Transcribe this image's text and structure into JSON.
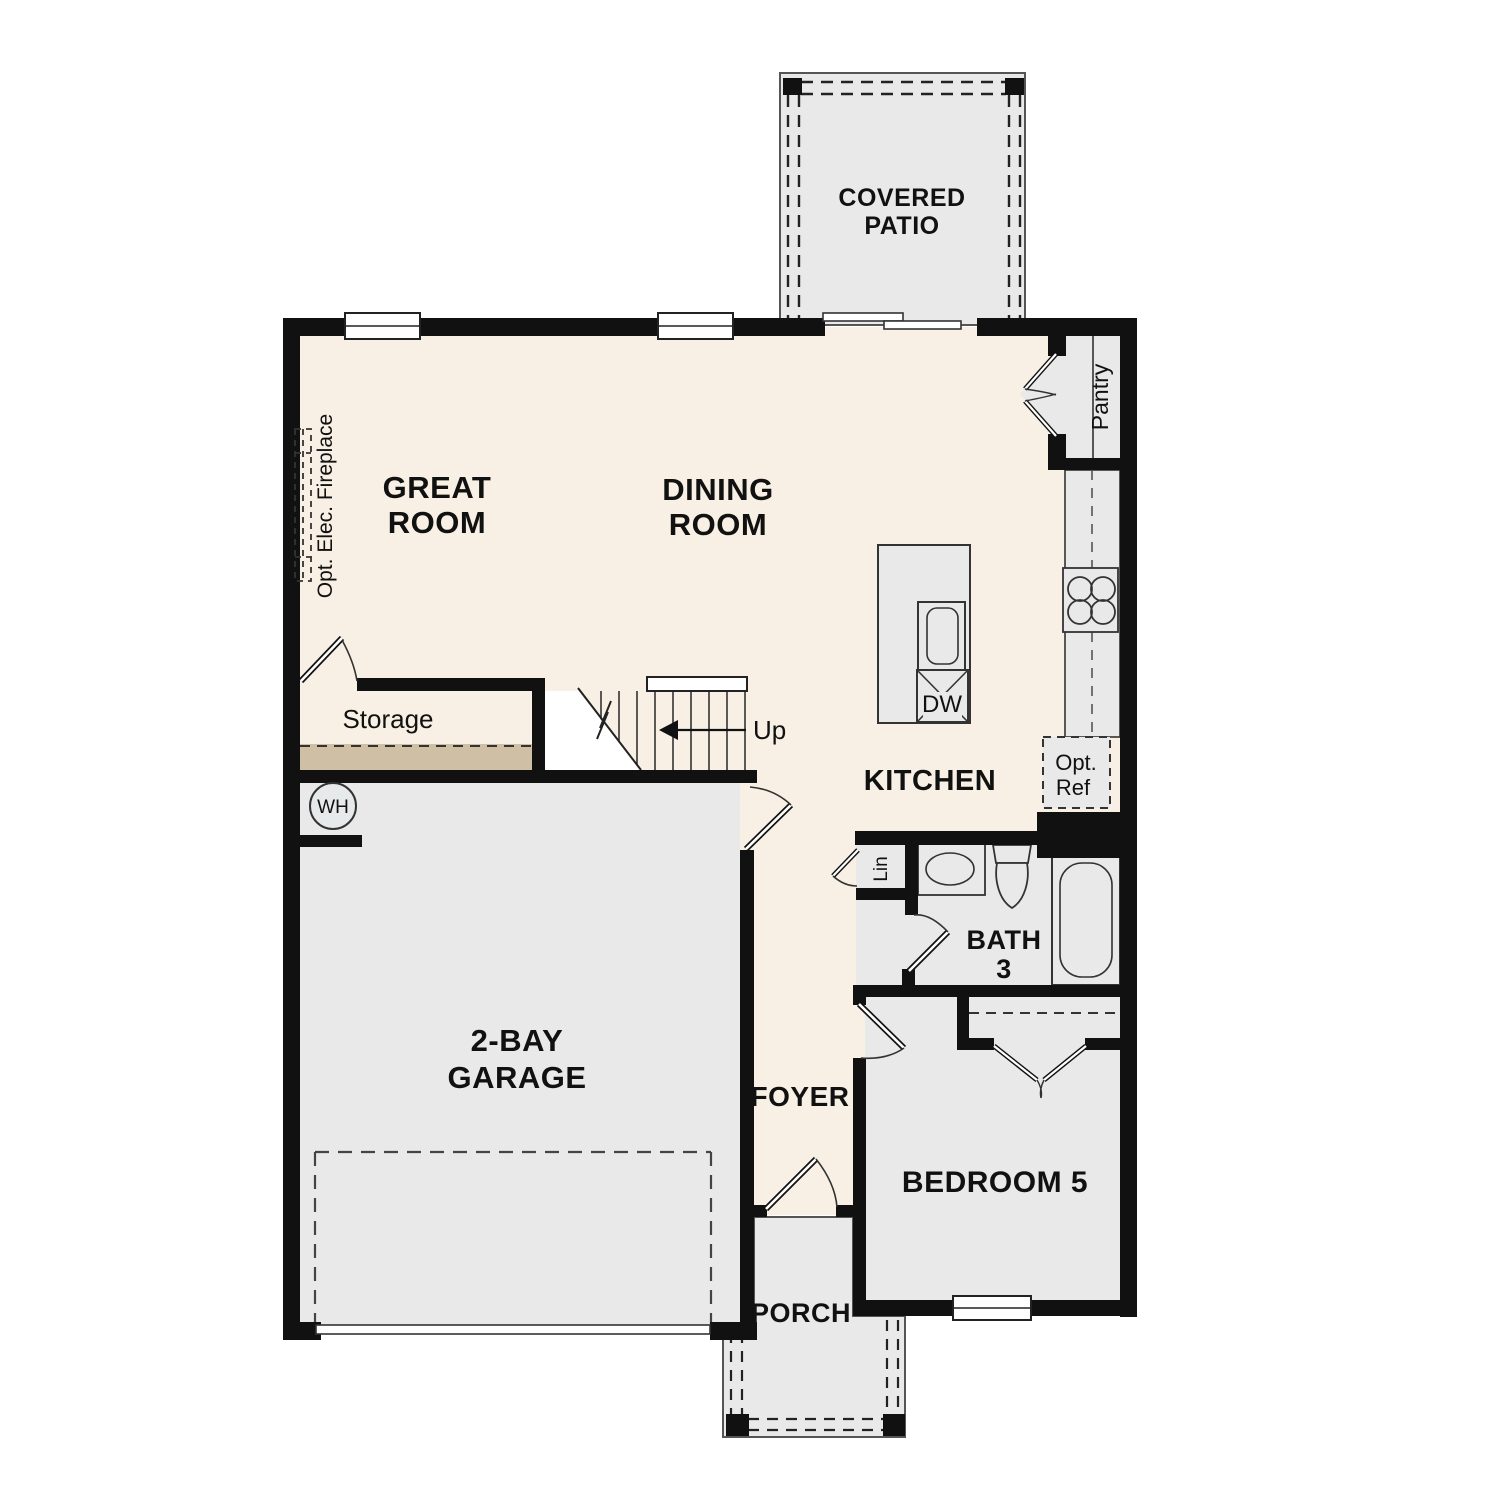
{
  "meta": {
    "type": "floor-plan",
    "description": "Single family home first-floor plan"
  },
  "colors": {
    "background": "#ffffff",
    "floor_cream": "#f8f0e4",
    "room_gray": "#e9e9e9",
    "tan_strip": "#cfc0a5",
    "wall": "#111111",
    "line": "#333333"
  },
  "labels": {
    "covered_patio": [
      "COVERED",
      "PATIO"
    ],
    "great_room": [
      "GREAT",
      "ROOM"
    ],
    "dining_room": [
      "DINING",
      "ROOM"
    ],
    "kitchen": "KITCHEN",
    "pantry": "Pantry",
    "opt_ref": [
      "Opt.",
      "Ref"
    ],
    "opt_fireplace": "Opt. Elec. Fireplace",
    "storage": "Storage",
    "stairs_up": "Up",
    "dishwasher": "DW",
    "water_heater": "WH",
    "garage": [
      "2-BAY",
      "GARAGE"
    ],
    "foyer": "FOYER",
    "bath3": [
      "BATH",
      "3"
    ],
    "linen": "Lin",
    "bedroom5": "BEDROOM 5",
    "porch": "PORCH"
  }
}
